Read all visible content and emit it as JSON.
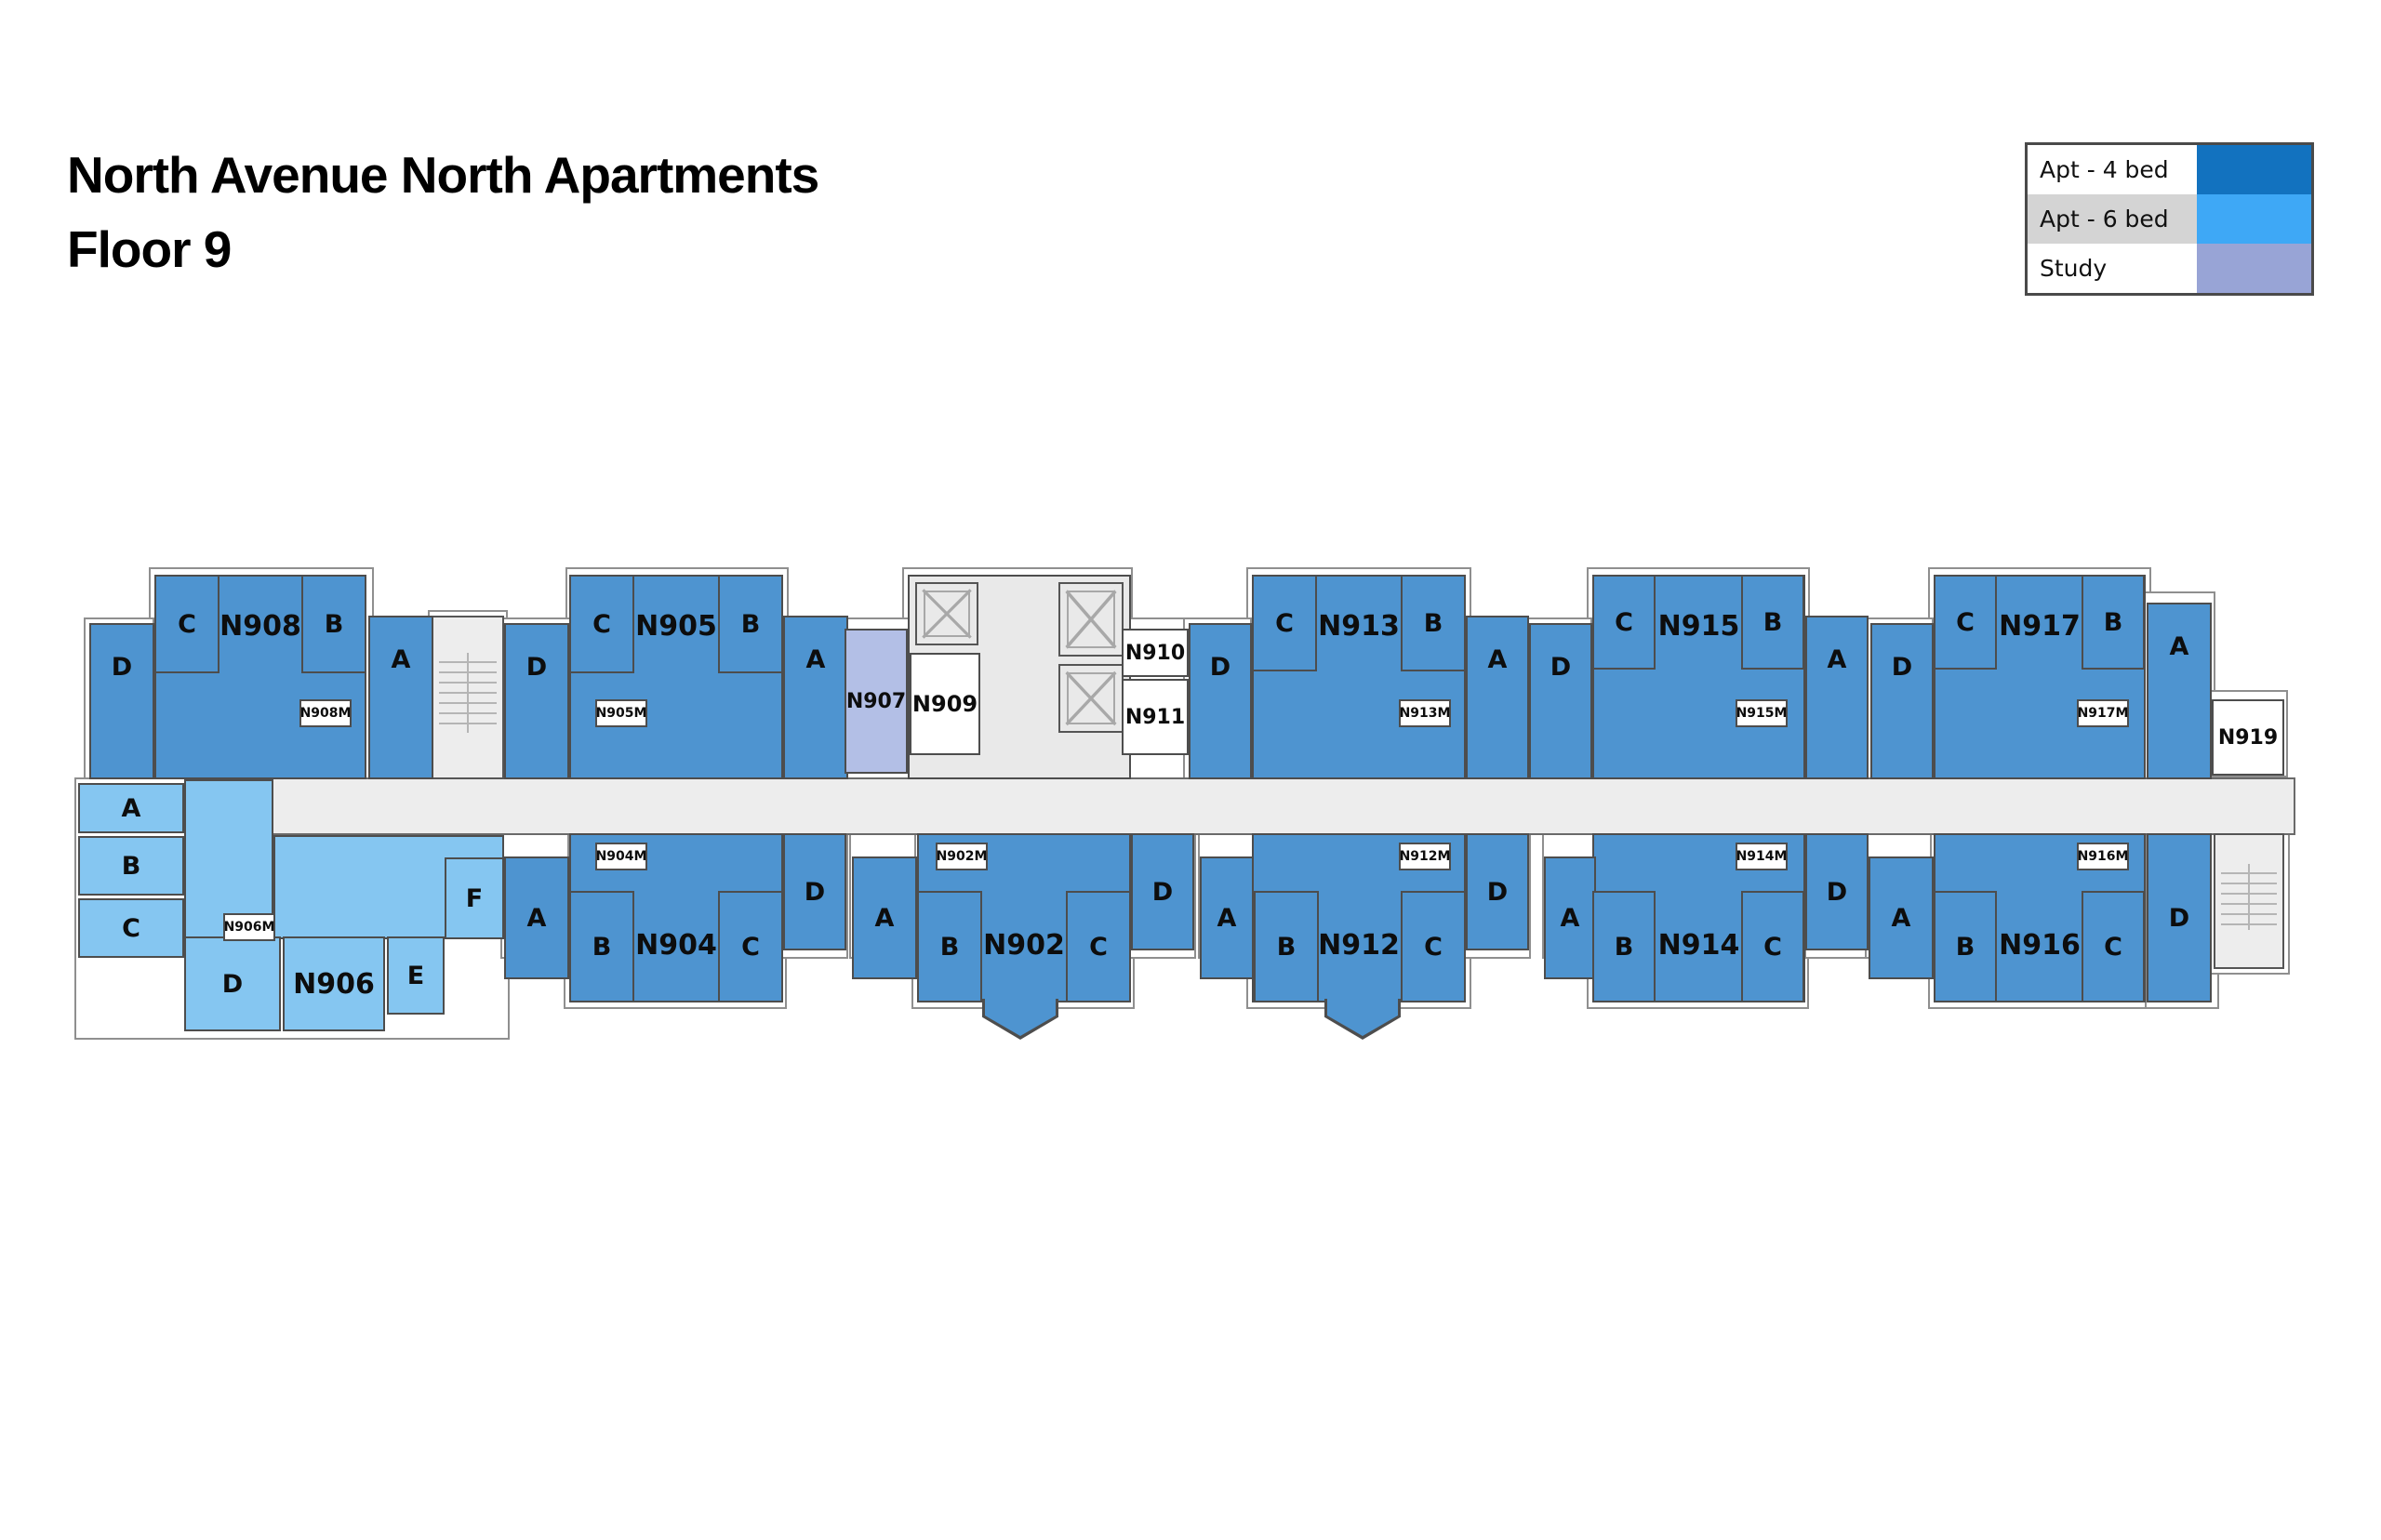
{
  "title": {
    "line1": "North Avenue North Apartments",
    "line2": "Floor 9"
  },
  "legend": {
    "items": [
      {
        "label": "Apt - 4 bed",
        "swatch": "#1272bf"
      },
      {
        "label": "Apt - 6 bed",
        "swatch": "#3ea8f6"
      },
      {
        "label": "Study",
        "swatch": "#98a4d6"
      }
    ]
  },
  "palette": {
    "apt4_room": "#4e94d0",
    "apt6_room": "#85c6f1",
    "study_room": "#b3bfe6",
    "corridor": "#ededed",
    "wall": "#4d4d4d"
  },
  "letters": {
    "A": "A",
    "B": "B",
    "C": "C",
    "D": "D",
    "E": "E",
    "F": "F"
  },
  "units": {
    "N902": "N902",
    "N902M": "N902M",
    "N904": "N904",
    "N904M": "N904M",
    "N905": "N905",
    "N905M": "N905M",
    "N906": "N906",
    "N906M": "N906M",
    "N907": "N907",
    "N908": "N908",
    "N908M": "N908M",
    "N909": "N909",
    "N910": "N910",
    "N911": "N911",
    "N912": "N912",
    "N912M": "N912M",
    "N913": "N913",
    "N913M": "N913M",
    "N914": "N914",
    "N914M": "N914M",
    "N915": "N915",
    "N915M": "N915M",
    "N916": "N916",
    "N916M": "N916M",
    "N917": "N917",
    "N917M": "N917M",
    "N919": "N919"
  }
}
